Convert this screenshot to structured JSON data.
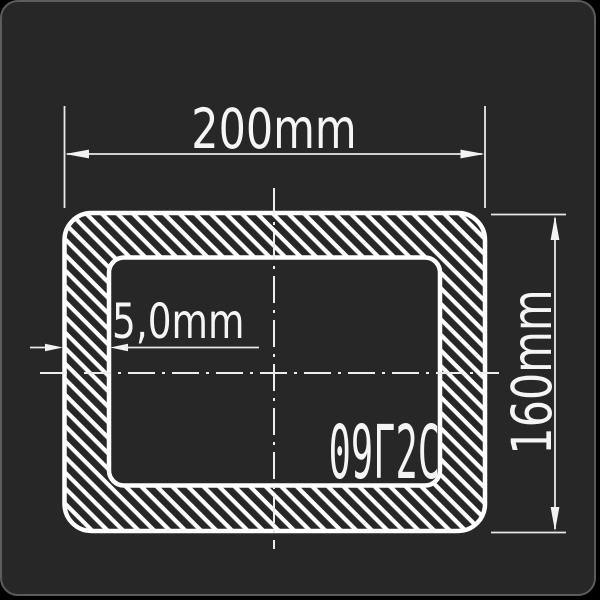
{
  "diagram": {
    "type": "rectangular-tube-cross-section",
    "dimensions": {
      "width_label": "200mm",
      "height_label": "160mm",
      "thickness_label": "5,0mm"
    },
    "steel_grade": "09Г2С",
    "colors": {
      "page_background": "#000000",
      "card_background": "#272727",
      "card_border": "#5c5c5c",
      "profile_outline": "#ffffff",
      "hatch_stripe": "#ffffff",
      "dimension_line": "#e9e9e9",
      "label_text": "#f5f5f5"
    }
  }
}
